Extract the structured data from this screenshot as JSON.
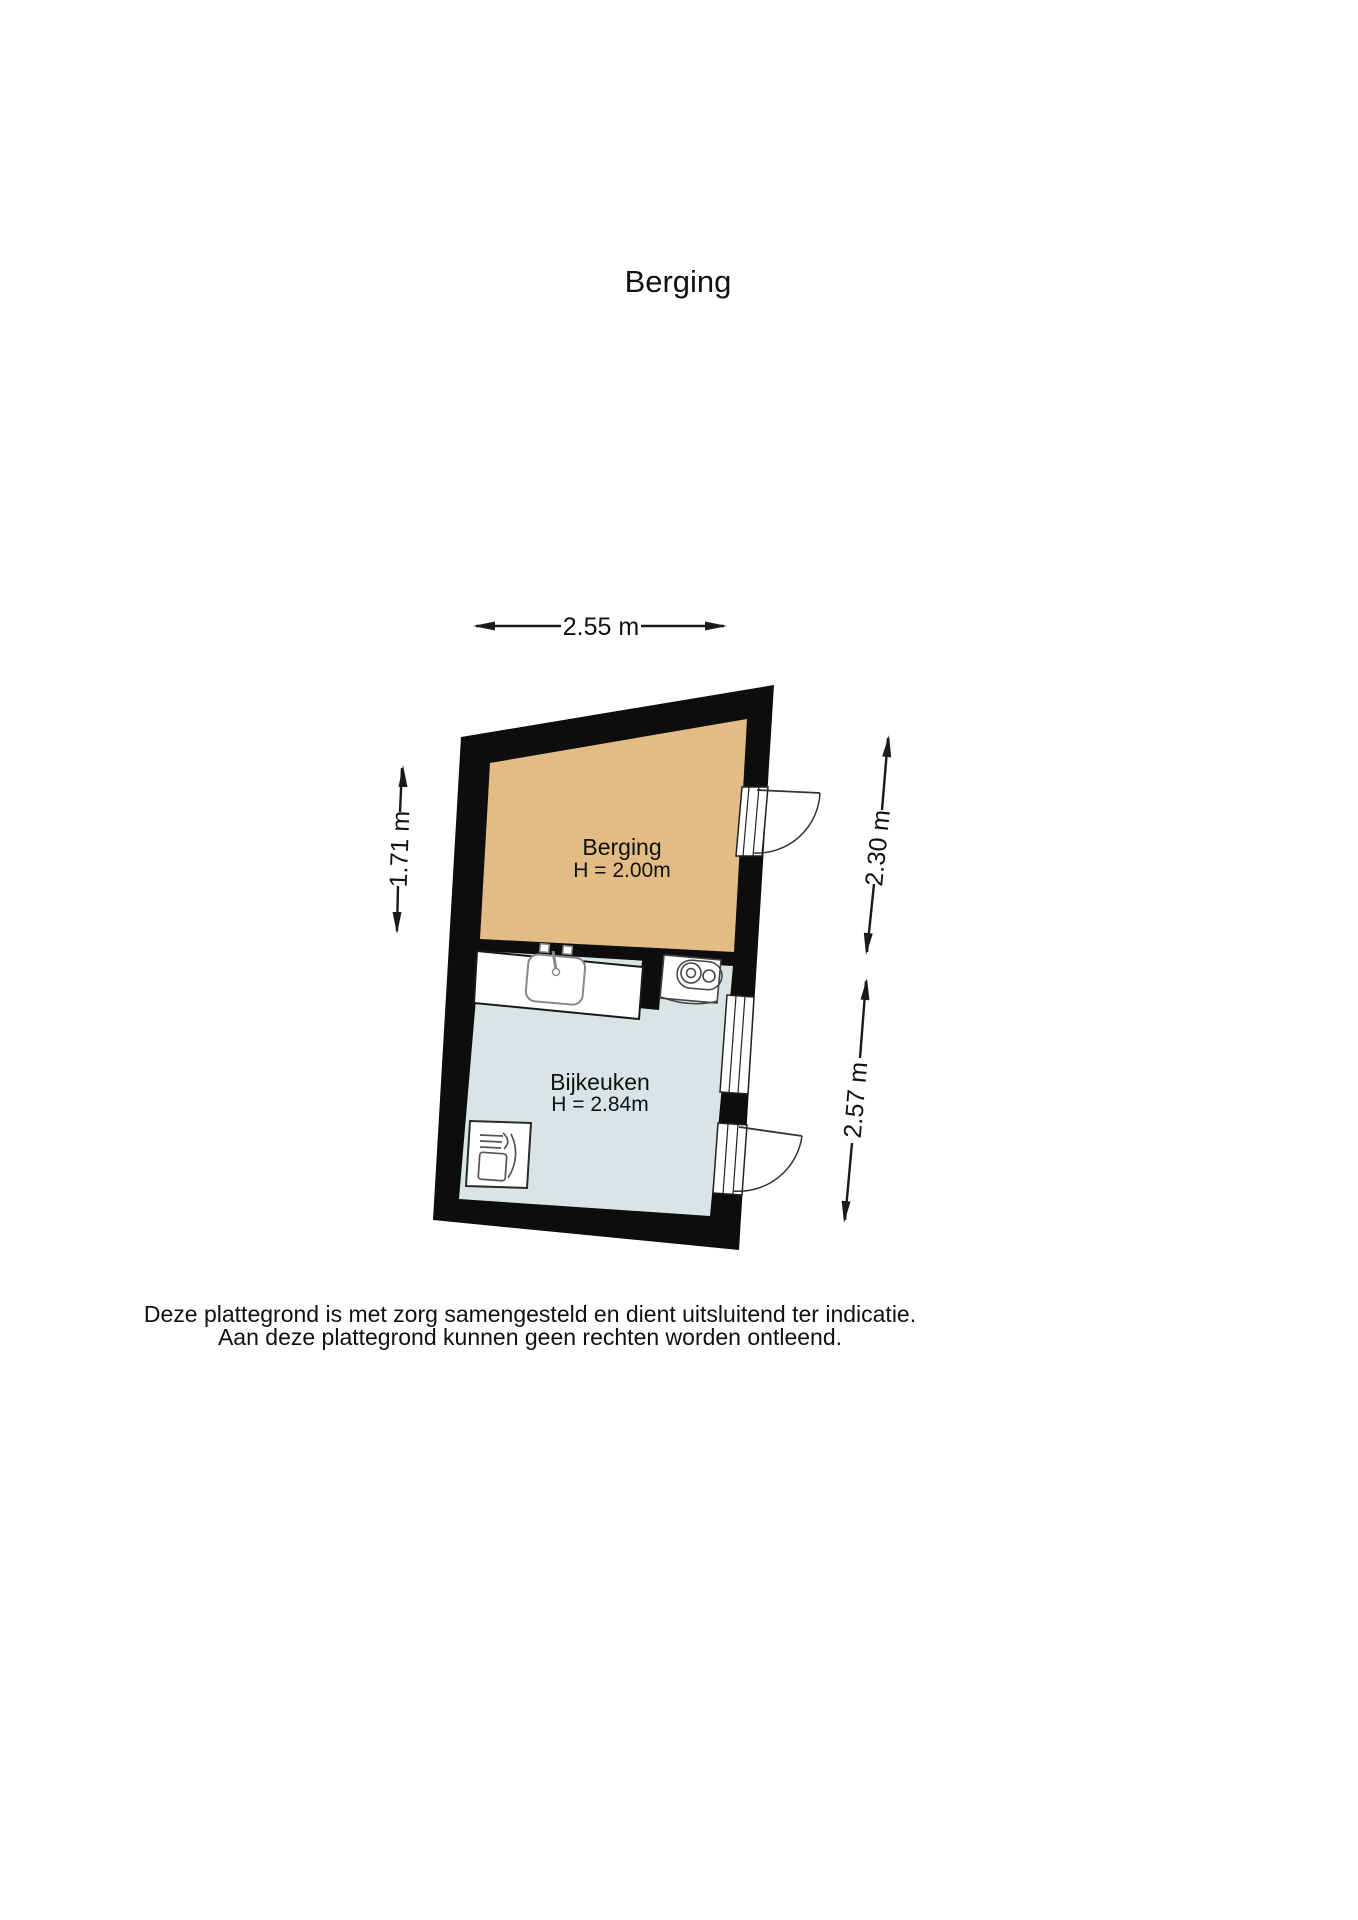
{
  "page": {
    "title": "Berging"
  },
  "floorplan": {
    "rooms": [
      {
        "name": "Berging",
        "height_label": "H = 2.00m",
        "fill": "#e2bc84"
      },
      {
        "name": "Bijkeuken",
        "height_label": "H = 2.84m",
        "fill": "#d9e5e5"
      }
    ],
    "dimensions": {
      "top_width": "2.55 m",
      "left_height": "1.71 m",
      "right_upper_height": "2.30 m",
      "right_lower_height": "2.57 m"
    },
    "fixtures": [
      {
        "icon": "sink-icon"
      },
      {
        "icon": "boiler-icon"
      },
      {
        "icon": "dishwasher-icon"
      },
      {
        "icon": "door-icon"
      },
      {
        "icon": "window-icon"
      }
    ],
    "wall_color": "#0d0d0d"
  },
  "footer": {
    "line1": "Deze plattegrond is met zorg samengesteld en dient uitsluitend ter indicatie.",
    "line2": "Aan deze plattegrond kunnen geen rechten worden ontleend."
  }
}
